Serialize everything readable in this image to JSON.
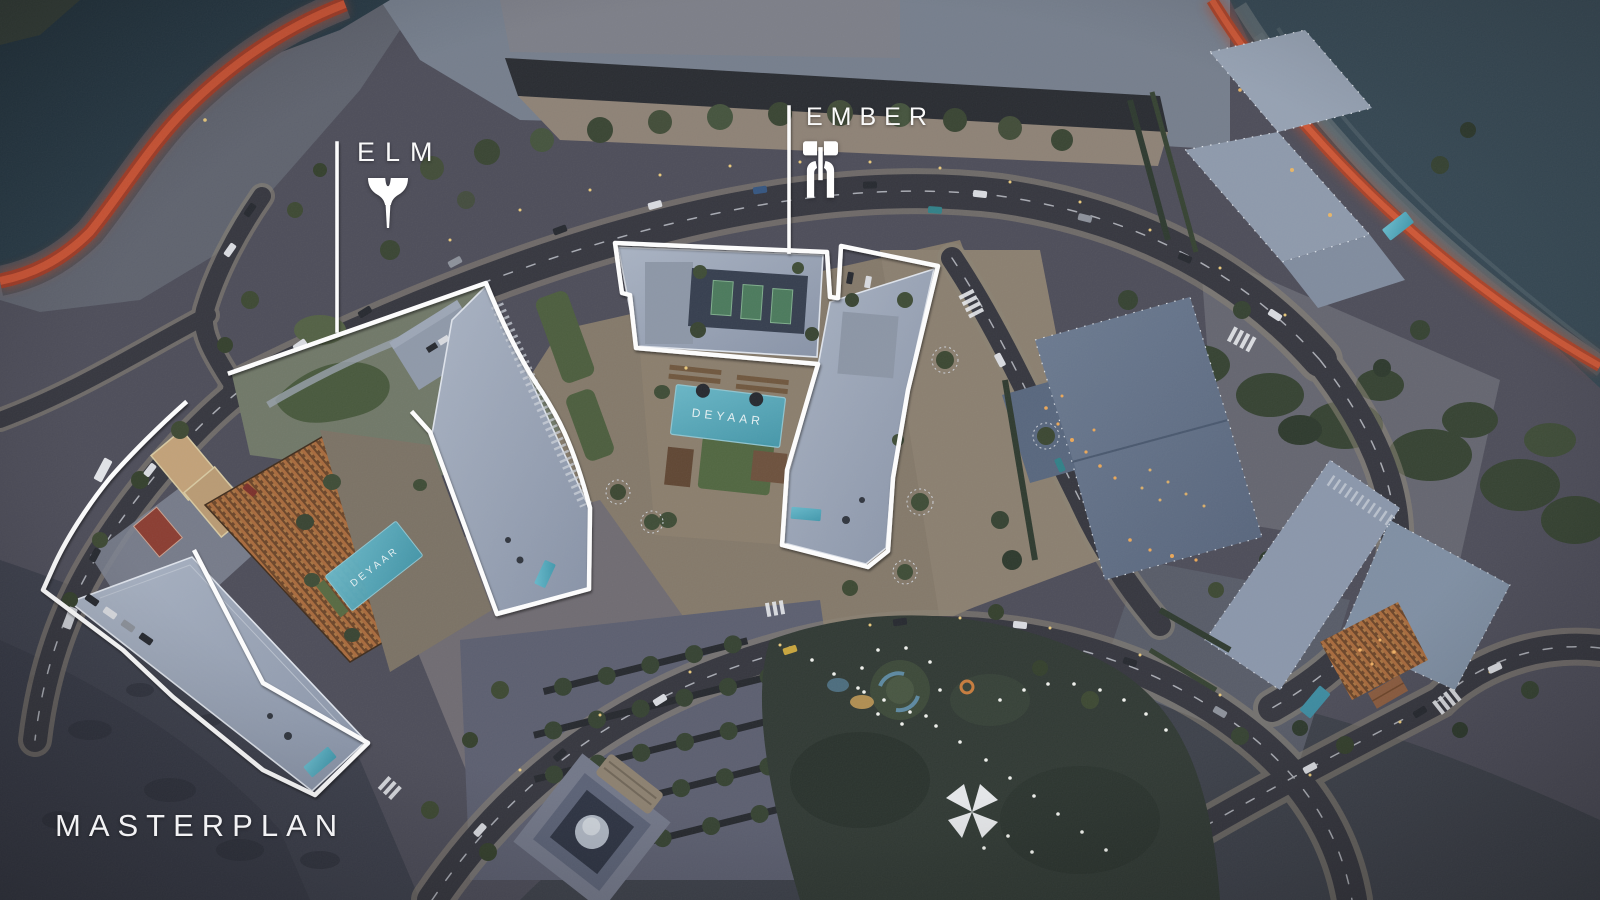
{
  "title": {
    "text": "MASTERPLAN"
  },
  "plots": {
    "elm": {
      "label": "ELM",
      "icon": "elm-logo-icon"
    },
    "ember": {
      "label": "EMBER",
      "icon": "ember-logo-icon"
    }
  },
  "branding": {
    "pool_canopy_text": "DEYAAR"
  },
  "colors": {
    "plot_outline": "#ffffff",
    "waterfront_track": "#c4502f",
    "pool": "#55aec2",
    "canopy": "#6aa9b4",
    "night_light": "#f0c878",
    "water_dark": "#263945",
    "water_light": "#33454f"
  }
}
